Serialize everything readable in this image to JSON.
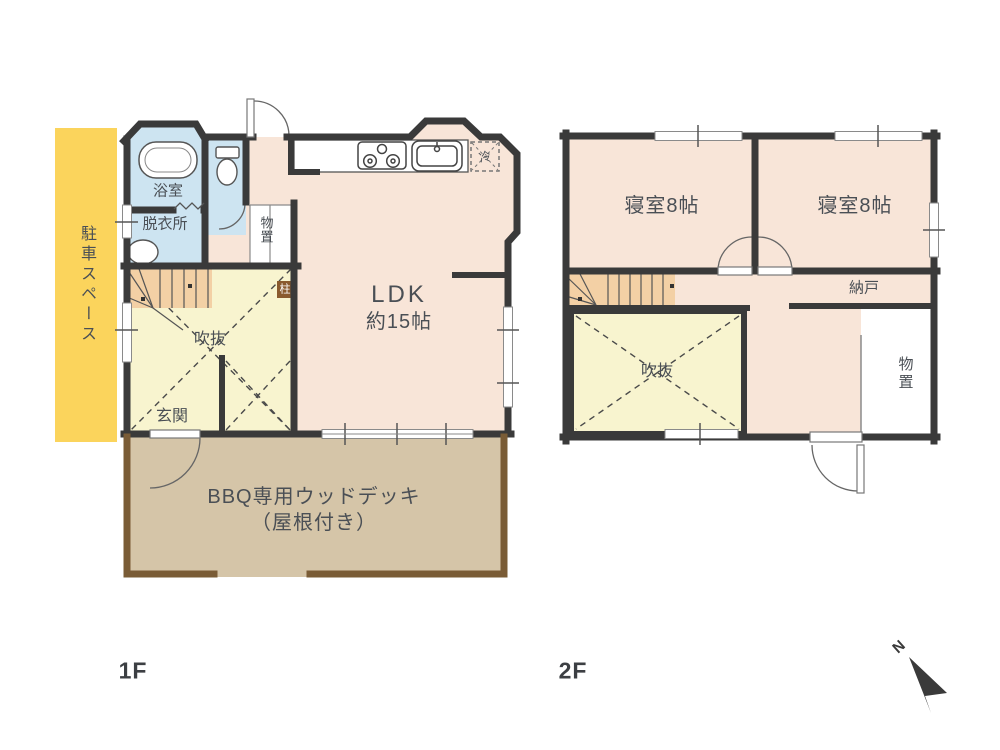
{
  "colors": {
    "wall": "#3a3a3a",
    "room_pink": "#f8e5d8",
    "wet_blue": "#cde4f1",
    "void_yellow": "#f8f4cf",
    "stair_tan": "#f3d0a5",
    "parking_yellow": "#fbd45c",
    "deck_fill": "#d5c5a8",
    "deck_border": "#7a5c36",
    "pillar_brown": "#8a5a2e",
    "text": "#4a4f55",
    "fixture_line": "#666666"
  },
  "floor1": {
    "label": "1F",
    "parking": "駐車スペース",
    "bath": "浴室",
    "dressing": "脱衣所",
    "storage": "物置",
    "ldk_name": "LDK",
    "ldk_size": "約15帖",
    "void": "吹抜",
    "entrance": "玄関",
    "pillar": "柱",
    "fridge": "冷",
    "deck_line1": "BBQ専用ウッドデッキ",
    "deck_line2": "（屋根付き）"
  },
  "floor2": {
    "label": "2F",
    "bedroom_left": "寝室8帖",
    "bedroom_right": "寝室8帖",
    "closet": "納戸",
    "void": "吹抜",
    "storage": "物置"
  },
  "compass": {
    "north": "N"
  }
}
